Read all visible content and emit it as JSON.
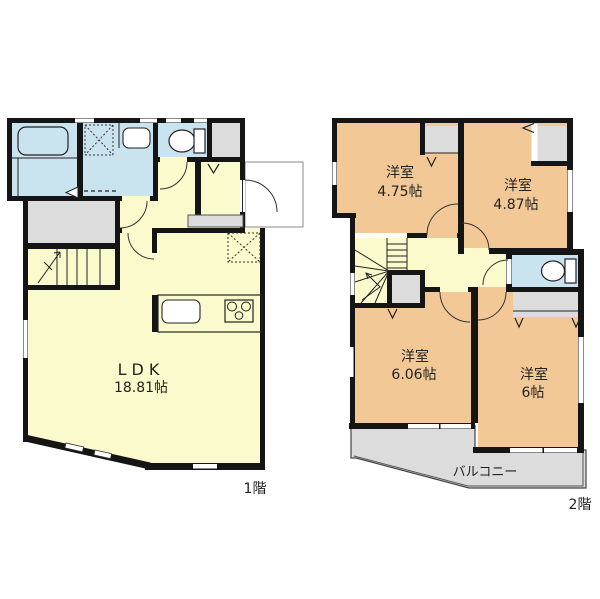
{
  "colors": {
    "floor_yellow": "#FAFACD",
    "room_orange": "#F2C996",
    "wet_blue": "#C9E3EF",
    "closet_gray": "#DCDCDC",
    "balcony_gray": "#DCDCDC",
    "wall": "#151515"
  },
  "f1": {
    "label": "1階",
    "ldk": {
      "name": "LDK",
      "size": "18.81帖"
    }
  },
  "f2": {
    "label": "2階",
    "r1": {
      "name": "洋室",
      "size": "4.75帖"
    },
    "r2": {
      "name": "洋室",
      "size": "4.87帖"
    },
    "r3": {
      "name": "洋室",
      "size": "6.06帖"
    },
    "r4": {
      "name": "洋室",
      "size": "6帖"
    },
    "balcony": "バルコニー"
  }
}
